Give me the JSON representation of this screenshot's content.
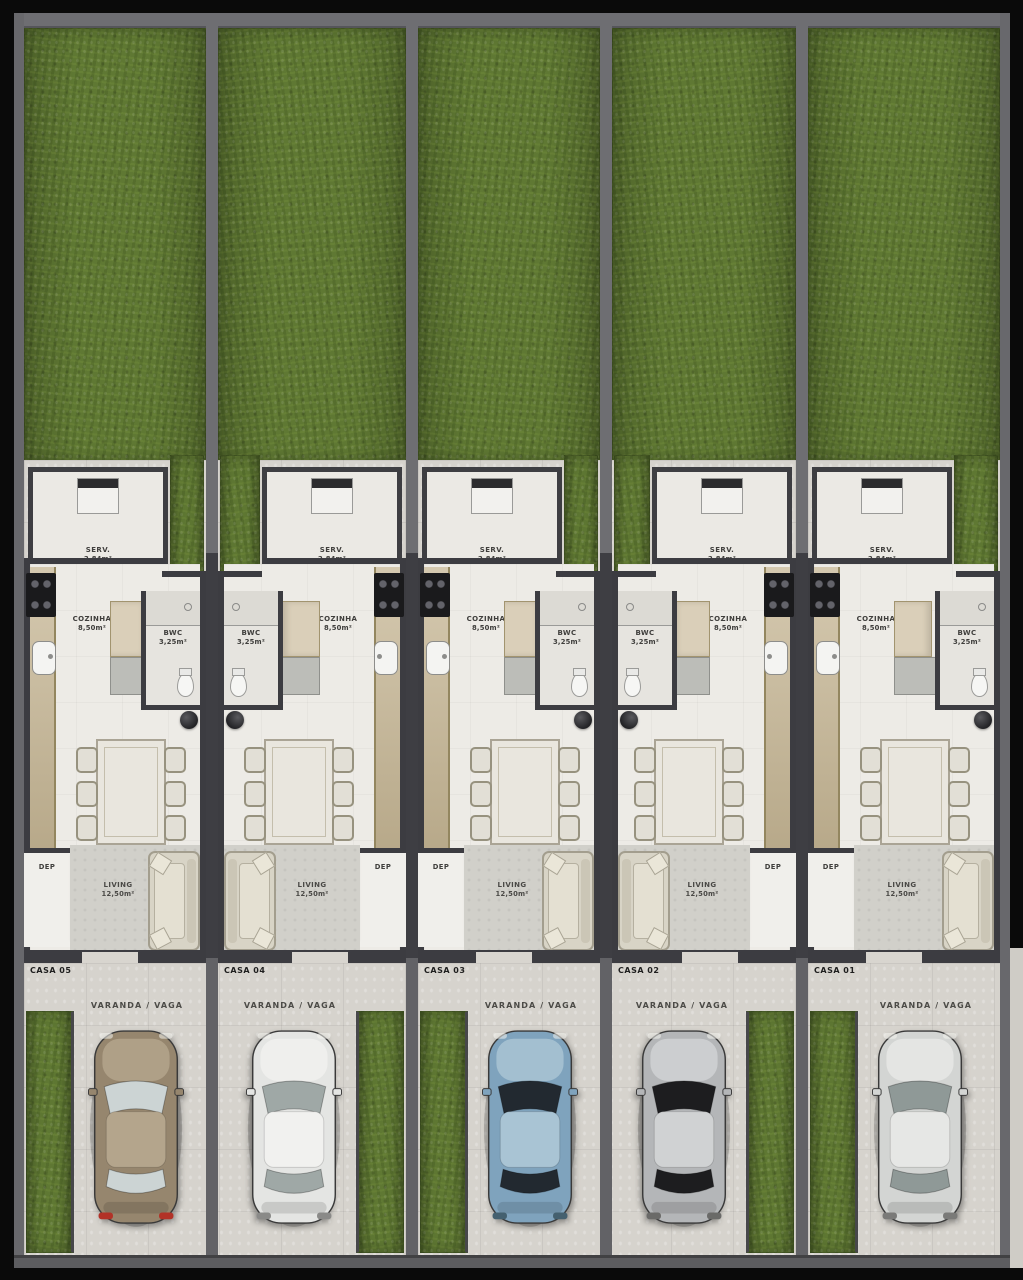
{
  "scene": {
    "description": "Top-down 3D site plan rendering of five attached row houses with back gardens, furnished floor plans and front parking spots with cars"
  },
  "labels": {
    "varanda": "VARANDA / VAGA"
  },
  "colors": {
    "grass": "#5f7833",
    "paving": "#d6d3cd",
    "interior_floor": "#edebe6",
    "walls": "#3c3c41",
    "counter_wood": "#c7b795",
    "dep_door": "#a8834e",
    "frame": "#000000"
  },
  "units": [
    {
      "id": "casa-05",
      "house_label": "CASA 05",
      "mirrored": false,
      "layout": {
        "left": 24,
        "width": 182
      },
      "rooms": {
        "serv": {
          "name": "SERV.",
          "area": "2,84m²"
        },
        "cozinha": {
          "name": "COZINHA",
          "area": "8,50m²"
        },
        "bwc": {
          "name": "BWC",
          "area": "3,25m²"
        },
        "living": {
          "name": "LIVING",
          "area": "12,50m²"
        },
        "dep": {
          "name": "DEP"
        }
      },
      "car": {
        "type": "beige-suv",
        "body": "#96866e",
        "roof": "#b4a58c",
        "glass": "#ccd4d4",
        "tail": "#b23227"
      }
    },
    {
      "id": "casa-04",
      "house_label": "CASA 04",
      "mirrored": true,
      "layout": {
        "left": 218,
        "width": 188
      },
      "rooms": {
        "serv": {
          "name": "SERV.",
          "area": "2,84m²"
        },
        "cozinha": {
          "name": "COZINHA",
          "area": "8,50m²"
        },
        "bwc": {
          "name": "BWC",
          "area": "3,25m²"
        },
        "living": {
          "name": "LIVING",
          "area": "12,50m²"
        },
        "dep": {
          "name": "DEP"
        }
      },
      "car": {
        "type": "white-sedan",
        "body": "#e4e5e3",
        "roof": "#f1f1ef",
        "glass": "#9fa8a6",
        "tail": "#8a8a88"
      }
    },
    {
      "id": "casa-03",
      "house_label": "CASA 03",
      "mirrored": false,
      "layout": {
        "left": 418,
        "width": 182
      },
      "rooms": {
        "serv": {
          "name": "SERV.",
          "area": "2,84m²"
        },
        "cozinha": {
          "name": "COZINHA",
          "area": "8,50m²"
        },
        "bwc": {
          "name": "BWC",
          "area": "3,25m²"
        },
        "living": {
          "name": "LIVING",
          "area": "12,50m²"
        },
        "dep": {
          "name": "DEP"
        }
      },
      "car": {
        "type": "blue-sedan",
        "body": "#7fa3bd",
        "roof": "#a9c4d4",
        "glass": "#222930",
        "tail": "#44606f"
      }
    },
    {
      "id": "casa-02",
      "house_label": "CASA 02",
      "mirrored": true,
      "layout": {
        "left": 612,
        "width": 184
      },
      "rooms": {
        "serv": {
          "name": "SERV.",
          "area": "2,84m²"
        },
        "cozinha": {
          "name": "COZINHA",
          "area": "8,50m²"
        },
        "bwc": {
          "name": "BWC",
          "area": "3,25m²"
        },
        "living": {
          "name": "LIVING",
          "area": "12,50m²"
        },
        "dep": {
          "name": "DEP"
        }
      },
      "car": {
        "type": "silver-sedan-dark-glass",
        "body": "#b4b6b8",
        "roof": "#d0d2d3",
        "glass": "#1d1d1f",
        "tail": "#6a6a68"
      }
    },
    {
      "id": "casa-01",
      "house_label": "CASA 01",
      "mirrored": false,
      "layout": {
        "left": 808,
        "width": 192
      },
      "rooms": {
        "serv": {
          "name": "SERV.",
          "area": "2,84m²"
        },
        "cozinha": {
          "name": "COZINHA",
          "area": "8,50m²"
        },
        "bwc": {
          "name": "BWC",
          "area": "3,25m²"
        },
        "living": {
          "name": "LIVING",
          "area": "12,50m²"
        },
        "dep": {
          "name": "DEP"
        }
      },
      "car": {
        "type": "light-silver-sedan",
        "body": "#d3d5d3",
        "roof": "#e6e7e5",
        "glass": "#8f9997",
        "tail": "#7a7a78"
      }
    }
  ],
  "dividers": {
    "x_positions": [
      206,
      406,
      600,
      796
    ]
  }
}
